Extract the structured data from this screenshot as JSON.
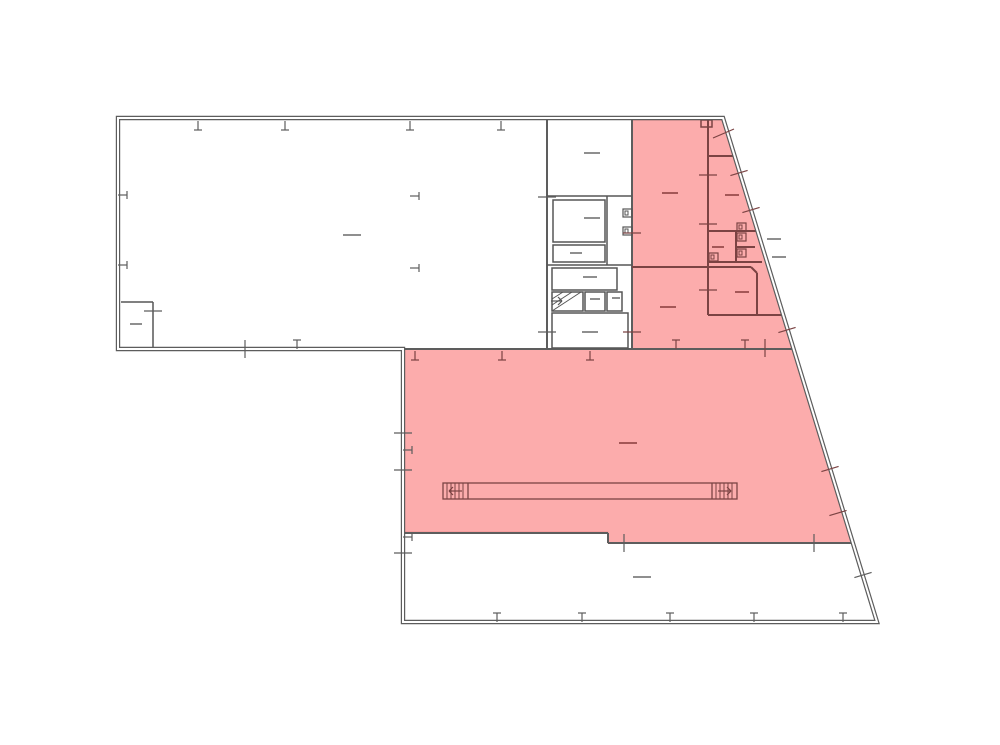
{
  "meta": {
    "canvas": {
      "width": 1000,
      "height": 745
    },
    "description_names": [
      "floor-plan",
      "highlighted-selection"
    ]
  },
  "colors": {
    "background": "#ffffff",
    "wall": "#5d5d5d",
    "wall_core": "#ffffff",
    "partition": "#565656",
    "pink_fill": "#fcacac",
    "pink_edge": "#ef9191",
    "pink_wall": "#7b4343",
    "dash_gray": "#8f8f8f",
    "dash_red": "#a45757"
  },
  "outline_path": "M118,118 H723 L877,622 H403 V349 H118 Z",
  "highlight_regions": [
    {
      "name": "highlight-upper-right",
      "points": "632,120 723,120 794,350 632,350"
    },
    {
      "name": "highlight-lower-hall",
      "points": "404,349 794,349 853,543 608,543 608,532 404,532"
    }
  ],
  "walls_main": [
    [
      547,
      120,
      547,
      349
    ],
    [
      632,
      120,
      632,
      349
    ],
    [
      403,
      349,
      794,
      349
    ],
    [
      403,
      533,
      608,
      533
    ],
    [
      608,
      533,
      608,
      543
    ],
    [
      608,
      543,
      853,
      543
    ]
  ],
  "partition_lines": [
    [
      121,
      302,
      153,
      302
    ],
    [
      153,
      302,
      153,
      349
    ],
    [
      547,
      196,
      632,
      196
    ],
    [
      607,
      196,
      607,
      265
    ],
    [
      547,
      265,
      632,
      265
    ]
  ],
  "partition_rects": [
    [
      553,
      200,
      52,
      42
    ],
    [
      553,
      245,
      52,
      17
    ],
    [
      552,
      268,
      65,
      22
    ],
    [
      552,
      292,
      31,
      19
    ],
    [
      585,
      292,
      20,
      19
    ],
    [
      607,
      292,
      15,
      19
    ],
    [
      552,
      313,
      76,
      35
    ]
  ],
  "walls_pink": [
    [
      708,
      120,
      708,
      315
    ],
    [
      708,
      156,
      734,
      156
    ],
    [
      708,
      231,
      757,
      231
    ],
    [
      632,
      267,
      751,
      267
    ],
    [
      751,
      267,
      757,
      273
    ],
    [
      757,
      273,
      757,
      315
    ],
    [
      708,
      315,
      783,
      315
    ],
    [
      708,
      262,
      762,
      262
    ],
    [
      736,
      231,
      736,
      262
    ],
    [
      736,
      247,
      755,
      247
    ]
  ],
  "pink_rects": [
    [
      701,
      120,
      11,
      7
    ]
  ],
  "fixtures_gray": [
    [
      623,
      209,
      9,
      8
    ],
    [
      623,
      227,
      9,
      8
    ]
  ],
  "fixtures_pink": [
    [
      737,
      223,
      9,
      8
    ],
    [
      737,
      233,
      9,
      8
    ],
    [
      737,
      249,
      9,
      8
    ],
    [
      709,
      253,
      9,
      8
    ]
  ],
  "stair": {
    "hatch": [
      [
        552,
        311,
        581,
        292
      ],
      [
        552,
        305,
        572,
        292
      ],
      [
        552,
        299,
        563,
        292
      ]
    ],
    "arrow": {
      "shaft": [
        551,
        301,
        562,
        301
      ],
      "head": "e"
    }
  },
  "ramp": {
    "rect": [
      443,
      483,
      294,
      16
    ],
    "dividers": [
      [
        468,
        483,
        468,
        499
      ],
      [
        712,
        483,
        712,
        499
      ]
    ],
    "hatch_x_left": [
      447,
      451,
      455,
      459,
      463
    ],
    "hatch_x_right": [
      716,
      720,
      724,
      728,
      732
    ],
    "hatch_y": [
      483,
      499
    ],
    "arrows": [
      {
        "shaft": [
          449,
          491,
          462,
          491
        ],
        "head": "w"
      },
      {
        "shaft": [
          718,
          491,
          731,
          491
        ],
        "head": "e"
      }
    ]
  },
  "door_swings": [
    [
      713,
      138,
      734,
      129
    ]
  ],
  "ticks_t": [
    {
      "x": 198,
      "y": 121,
      "d": "s"
    },
    {
      "x": 285,
      "y": 121,
      "d": "s"
    },
    {
      "x": 410,
      "y": 121,
      "d": "s"
    },
    {
      "x": 501,
      "y": 121,
      "d": "s"
    },
    {
      "x": 118,
      "y": 195,
      "d": "e"
    },
    {
      "x": 118,
      "y": 265,
      "d": "e"
    },
    {
      "x": 297,
      "y": 349,
      "d": "n"
    },
    {
      "x": 497,
      "y": 622,
      "d": "n"
    },
    {
      "x": 582,
      "y": 622,
      "d": "n"
    },
    {
      "x": 670,
      "y": 622,
      "d": "n"
    },
    {
      "x": 754,
      "y": 622,
      "d": "n"
    },
    {
      "x": 843,
      "y": 622,
      "d": "n"
    },
    {
      "x": 403,
      "y": 450,
      "d": "e"
    },
    {
      "x": 403,
      "y": 537,
      "d": "e"
    },
    {
      "x": 410,
      "y": 196,
      "d": "e"
    },
    {
      "x": 410,
      "y": 268,
      "d": "e"
    },
    {
      "x": 415,
      "y": 351,
      "d": "s",
      "pink": true
    },
    {
      "x": 502,
      "y": 351,
      "d": "s",
      "pink": true
    },
    {
      "x": 590,
      "y": 351,
      "d": "s",
      "pink": true
    },
    {
      "x": 676,
      "y": 349,
      "d": "n",
      "pink": true
    },
    {
      "x": 745,
      "y": 349,
      "d": "n",
      "pink": true
    }
  ],
  "ticks_x": [
    {
      "x": 245,
      "y": 349,
      "o": "v"
    },
    {
      "x": 153,
      "y": 311,
      "o": "h"
    },
    {
      "x": 403,
      "y": 433,
      "o": "h"
    },
    {
      "x": 403,
      "y": 470,
      "o": "h"
    },
    {
      "x": 403,
      "y": 553,
      "o": "h"
    },
    {
      "x": 624,
      "y": 543,
      "o": "v"
    },
    {
      "x": 814,
      "y": 543,
      "o": "v"
    },
    {
      "x": 765,
      "y": 348,
      "o": "v",
      "pink": true
    },
    {
      "x": 632,
      "y": 233,
      "o": "h",
      "pink": true
    },
    {
      "x": 632,
      "y": 332,
      "o": "h",
      "pink": true
    },
    {
      "x": 547,
      "y": 197,
      "o": "h"
    },
    {
      "x": 547,
      "y": 332,
      "o": "h"
    },
    {
      "x": 708,
      "y": 175,
      "o": "h",
      "pink": true
    },
    {
      "x": 708,
      "y": 224,
      "o": "h",
      "pink": true
    },
    {
      "x": 708,
      "y": 290,
      "o": "h",
      "pink": true
    },
    {
      "x": 739,
      "y": 173,
      "o": "dg",
      "pink": true
    },
    {
      "x": 751,
      "y": 210,
      "o": "dg",
      "pink": true
    },
    {
      "x": 787,
      "y": 330,
      "o": "dg",
      "pink": true
    },
    {
      "x": 830,
      "y": 469,
      "o": "dg",
      "pink": true
    },
    {
      "x": 838,
      "y": 513,
      "o": "dg",
      "pink": true
    },
    {
      "x": 863,
      "y": 575,
      "o": "dg"
    }
  ],
  "label_dashes": [
    {
      "x": 352,
      "y": 235,
      "l": 18
    },
    {
      "x": 136,
      "y": 324,
      "l": 12
    },
    {
      "x": 592,
      "y": 153,
      "l": 16
    },
    {
      "x": 592,
      "y": 218,
      "l": 16
    },
    {
      "x": 576,
      "y": 253,
      "l": 12
    },
    {
      "x": 590,
      "y": 277,
      "l": 14
    },
    {
      "x": 595,
      "y": 299,
      "l": 10
    },
    {
      "x": 616,
      "y": 298,
      "l": 8
    },
    {
      "x": 590,
      "y": 332,
      "l": 16
    },
    {
      "x": 642,
      "y": 577,
      "l": 18
    },
    {
      "x": 670,
      "y": 193,
      "l": 16,
      "pink": true
    },
    {
      "x": 668,
      "y": 307,
      "l": 16,
      "pink": true
    },
    {
      "x": 732,
      "y": 195,
      "l": 14,
      "pink": true
    },
    {
      "x": 718,
      "y": 247,
      "l": 12,
      "pink": true
    },
    {
      "x": 742,
      "y": 292,
      "l": 14,
      "pink": true
    },
    {
      "x": 628,
      "y": 443,
      "l": 18,
      "pink": true
    },
    {
      "x": 774,
      "y": 239,
      "l": 14
    },
    {
      "x": 779,
      "y": 257,
      "l": 14
    }
  ]
}
